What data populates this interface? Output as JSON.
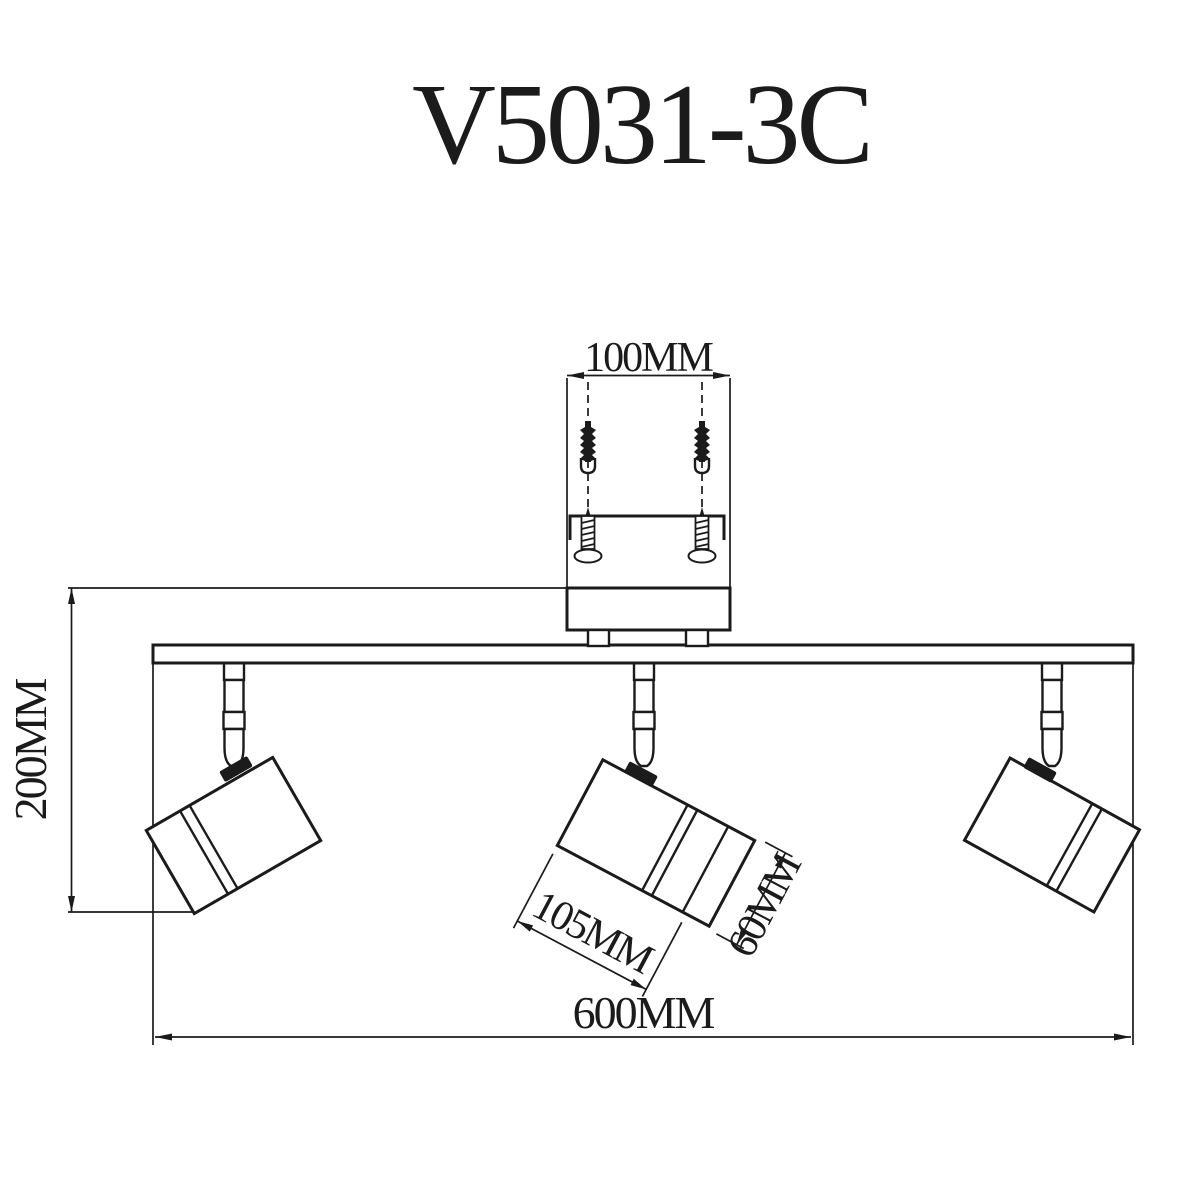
{
  "title": "V5031-3C",
  "labels": {
    "hole_spacing": "100MM",
    "drop_height": "200MM",
    "head_length": "105MM",
    "head_diameter": "60MM",
    "overall_width": "600MM"
  },
  "colors": {
    "line": "#1b1b1b",
    "background": "#ffffff"
  }
}
